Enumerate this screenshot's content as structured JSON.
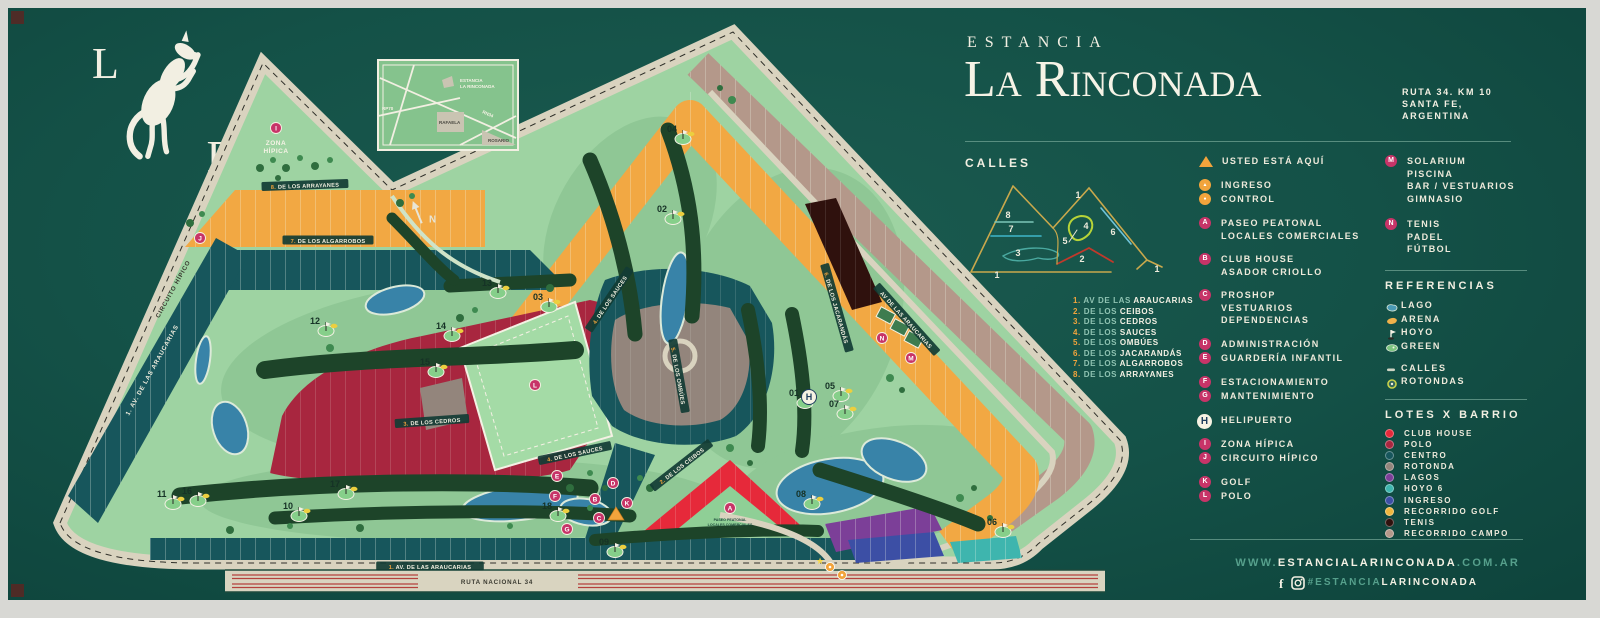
{
  "header": {
    "pretitle": "ESTANCIA",
    "title": "La Rinconada",
    "address": [
      "RUTA 34. KM 10",
      "SANTA FE,",
      "ARGENTINA"
    ]
  },
  "logo": {
    "letter_left": "L",
    "letter_right": "R",
    "icon": "rearing-horse"
  },
  "calles": {
    "heading": "CALLES",
    "streets": [
      {
        "num": "1.",
        "prefix": "AV DE LAS",
        "name": "ARAUCARIAS"
      },
      {
        "num": "2.",
        "prefix": "DE LOS",
        "name": "CEIBOS"
      },
      {
        "num": "3.",
        "prefix": "DE LOS",
        "name": "CEDROS"
      },
      {
        "num": "4.",
        "prefix": "DE LOS",
        "name": "SAUCES"
      },
      {
        "num": "5.",
        "prefix": "DE LOS",
        "name": "OMBÚES"
      },
      {
        "num": "6.",
        "prefix": "DE LOS",
        "name": "JACARANDÁS"
      },
      {
        "num": "7.",
        "prefix": "DE LOS",
        "name": "ALGARROBOS"
      },
      {
        "num": "8.",
        "prefix": "DE LOS",
        "name": "ARRAYANES"
      }
    ],
    "diagram_numbers": [
      {
        "n": "8",
        "x": 47,
        "y": 46
      },
      {
        "n": "7",
        "x": 50,
        "y": 60
      },
      {
        "n": "3",
        "x": 57,
        "y": 84
      },
      {
        "n": "1",
        "x": 36,
        "y": 106
      },
      {
        "n": "1",
        "x": 117,
        "y": 26
      },
      {
        "n": "4",
        "x": 125,
        "y": 57
      },
      {
        "n": "5",
        "x": 104,
        "y": 72
      },
      {
        "n": "2",
        "x": 121,
        "y": 90
      },
      {
        "n": "6",
        "x": 152,
        "y": 63
      },
      {
        "n": "1",
        "x": 196,
        "y": 100
      }
    ]
  },
  "legend": {
    "groups": [
      {
        "items": [
          {
            "marker": "triangle",
            "label_lines": [
              "USTED ESTÁ AQUÍ"
            ]
          }
        ]
      },
      {
        "items": [
          {
            "marker": "ingreso",
            "label_lines": [
              "INGRESO"
            ]
          },
          {
            "marker": "control",
            "label_lines": [
              "CONTROL"
            ]
          }
        ]
      },
      {
        "items": [
          {
            "marker": "A",
            "label_lines": [
              "PASEO PEATONAL",
              "LOCALES COMERCIALES"
            ]
          }
        ]
      },
      {
        "items": [
          {
            "marker": "B",
            "label_lines": [
              "CLUB HOUSE",
              "ASADOR CRIOLLO"
            ]
          }
        ]
      },
      {
        "items": [
          {
            "marker": "C",
            "label_lines": [
              "PROSHOP",
              "VESTUARIOS",
              "DEPENDENCIAS"
            ]
          }
        ]
      },
      {
        "items": [
          {
            "marker": "D",
            "label_lines": [
              "ADMINISTRACIÓN"
            ]
          },
          {
            "marker": "E",
            "label_lines": [
              "GUARDERÍA INFANTIL"
            ]
          }
        ]
      },
      {
        "items": [
          {
            "marker": "F",
            "label_lines": [
              "ESTACIONAMIENTO"
            ]
          },
          {
            "marker": "G",
            "label_lines": [
              "MANTENIMIENTO"
            ]
          }
        ]
      },
      {
        "items": [
          {
            "marker": "H",
            "style": "white",
            "label_lines": [
              "HELIPUERTO"
            ]
          }
        ]
      },
      {
        "items": [
          {
            "marker": "I",
            "label_lines": [
              "ZONA HÍPICA"
            ]
          },
          {
            "marker": "J",
            "label_lines": [
              "CIRCUITO HÍPICO"
            ]
          }
        ]
      },
      {
        "items": [
          {
            "marker": "K",
            "label_lines": [
              "GOLF"
            ]
          },
          {
            "marker": "L",
            "label_lines": [
              "POLO"
            ]
          }
        ]
      }
    ],
    "facilities": [
      {
        "marker": "M",
        "label_lines": [
          "SOLARIUM",
          "PISCINA",
          "BAR / VESTUARIOS",
          "GIMNASIO"
        ]
      },
      {
        "marker": "N",
        "label_lines": [
          "TENIS",
          "PADEL",
          "FÚTBOL"
        ]
      }
    ]
  },
  "referencias": {
    "heading": "REFERENCIAS",
    "items": [
      {
        "icon": "lago-icon",
        "label": "LAGO"
      },
      {
        "icon": "arena-icon",
        "label": "ARENA"
      },
      {
        "icon": "hoyo-icon",
        "label": "HOYO"
      },
      {
        "icon": "green-icon",
        "label": "GREEN"
      },
      {
        "icon": "calles-icon",
        "label": "CALLES",
        "gap_before": true
      },
      {
        "icon": "rotondas-icon",
        "label": "ROTONDAS"
      }
    ]
  },
  "lotes_x_barrio": {
    "heading": "LOTES X BARRIO",
    "items": [
      {
        "label": "CLUB HOUSE",
        "color": "#e6293a"
      },
      {
        "label": "POLO",
        "color": "#a8263f"
      },
      {
        "label": "CENTRO",
        "color": "#17565c"
      },
      {
        "label": "ROTONDA",
        "color": "#93857c"
      },
      {
        "label": "LAGOS",
        "color": "#7c3f98"
      },
      {
        "label": "HOYO 6",
        "color": "#3eb5ae"
      },
      {
        "label": "INGRESO",
        "color": "#3c4fa5"
      },
      {
        "label": "RECORRIDO GOLF",
        "color": "#f0b63e"
      },
      {
        "label": "TENIS",
        "color": "#2f110d"
      },
      {
        "label": "RECORRIDO CAMPO",
        "color": "#b4988a"
      }
    ]
  },
  "footer": {
    "url_pre": "WWW.",
    "url_main": "ESTANCIALARINCONADA",
    "url_suf": ".COM.AR",
    "tag_pre": "#ESTANCIA",
    "tag_main": "LARINCONADA",
    "icons": [
      "facebook-icon",
      "instagram-icon"
    ]
  },
  "map": {
    "zona_hipica": [
      "ZONA",
      "HÍPICA"
    ],
    "paseo_peatonal": [
      "PASEO PEATONAL",
      "LOCALES COMERCIALES"
    ],
    "north_label": "N",
    "inset": {
      "site": [
        "ESTANCIA",
        "LA RINCONADA"
      ],
      "city": "RAFAELA",
      "road_main": "RN34",
      "road_left": "RP70",
      "city2": "ROSARIO"
    },
    "street_labels": [
      {
        "text": "8. DE LOS ARRAYANES",
        "x": 275,
        "y": 168,
        "rot": -2,
        "style": "pill"
      },
      {
        "text": "7. DE LOS ALGARROBOS",
        "x": 298,
        "y": 223,
        "rot": 0,
        "style": "pill"
      },
      {
        "text": "3. DE LOS CEDROS",
        "x": 402,
        "y": 404,
        "rot": -4,
        "style": "pill"
      },
      {
        "text": "4. DE LOS SAUCES",
        "x": 580,
        "y": 282,
        "rot": -56,
        "style": "pill"
      },
      {
        "text": "4. DE LOS SAUCES",
        "x": 545,
        "y": 436,
        "rot": -12,
        "style": "pill"
      },
      {
        "text": "5. DE LOS OMBÚES",
        "x": 648,
        "y": 358,
        "rot": 80,
        "style": "pill"
      },
      {
        "text": "2. DE LOS CEIBOS",
        "x": 652,
        "y": 448,
        "rot": -38,
        "style": "pill"
      },
      {
        "text": "6. DE LOS JACARANDÁS",
        "x": 806,
        "y": 290,
        "rot": 74,
        "style": "pill"
      },
      {
        "text": "AV DE LAS ARAUCARIAS",
        "x": 876,
        "y": 302,
        "rot": 48,
        "style": "pill"
      },
      {
        "text": "1. AV. DE LAS ARAUCARIAS",
        "x": 400,
        "y": 549,
        "rot": 0,
        "style": "pill"
      },
      {
        "text": "1. AV. DE LAS ARAUCARIAS",
        "x": 122,
        "y": 352,
        "rot": -61,
        "style": "band"
      },
      {
        "text": "CIRCUITO HÍPICO",
        "x": 143,
        "y": 271,
        "rot": -61,
        "style": "road"
      },
      {
        "text": "RUTA NACIONAL 34",
        "x": 467,
        "y": 564,
        "rot": 0,
        "style": "road"
      }
    ],
    "holes": [
      {
        "n": "01",
        "x": 759,
        "y": 378
      },
      {
        "n": "02",
        "x": 627,
        "y": 194
      },
      {
        "n": "03",
        "x": 503,
        "y": 282
      },
      {
        "n": "04",
        "x": 637,
        "y": 114
      },
      {
        "n": "05",
        "x": 795,
        "y": 371
      },
      {
        "n": "06",
        "x": 957,
        "y": 507
      },
      {
        "n": "07",
        "x": 799,
        "y": 389
      },
      {
        "n": "08",
        "x": 766,
        "y": 479
      },
      {
        "n": "09",
        "x": 569,
        "y": 527
      },
      {
        "n": "10",
        "x": 253,
        "y": 491
      },
      {
        "n": "11",
        "x": 127,
        "y": 479
      },
      {
        "n": "12",
        "x": 280,
        "y": 306
      },
      {
        "n": "13",
        "x": 452,
        "y": 268
      },
      {
        "n": "14",
        "x": 406,
        "y": 311
      },
      {
        "n": "15",
        "x": 390,
        "y": 347
      },
      {
        "n": "16",
        "x": 152,
        "y": 476
      },
      {
        "n": "17",
        "x": 300,
        "y": 469
      },
      {
        "n": "18",
        "x": 512,
        "y": 491
      }
    ],
    "markers": [
      {
        "t": "pink",
        "l": "I",
        "x": 246,
        "y": 110
      },
      {
        "t": "pink",
        "l": "J",
        "x": 170,
        "y": 220
      },
      {
        "t": "pink",
        "l": "L",
        "x": 505,
        "y": 367
      },
      {
        "t": "pink",
        "l": "A",
        "x": 700,
        "y": 490
      },
      {
        "t": "pink",
        "l": "B",
        "x": 565,
        "y": 481
      },
      {
        "t": "pink",
        "l": "C",
        "x": 569,
        "y": 500
      },
      {
        "t": "pink",
        "l": "D",
        "x": 583,
        "y": 465
      },
      {
        "t": "pink",
        "l": "E",
        "x": 527,
        "y": 458
      },
      {
        "t": "pink",
        "l": "F",
        "x": 525,
        "y": 478
      },
      {
        "t": "pink",
        "l": "G",
        "x": 537,
        "y": 511
      },
      {
        "t": "pink",
        "l": "K",
        "x": 597,
        "y": 485
      },
      {
        "t": "white",
        "l": "H",
        "x": 779,
        "y": 379
      },
      {
        "t": "pink",
        "l": "M",
        "x": 881,
        "y": 340
      },
      {
        "t": "pink",
        "l": "N",
        "x": 852,
        "y": 320
      },
      {
        "t": "tri",
        "x": 586,
        "y": 497
      },
      {
        "t": "gate",
        "x": 800,
        "y": 549
      },
      {
        "t": "gate",
        "x": 812,
        "y": 557
      },
      {
        "t": "star",
        "x": 790,
        "y": 546
      }
    ],
    "visible_lot_number_ranges": [
      {
        "barrio": "CLUB HOUSE",
        "lots": "1-16"
      },
      {
        "barrio": "POLO",
        "lots": "18-39 y 338-372"
      },
      {
        "barrio": "CENTRO",
        "lots": "40-69, 253-294, 295-322, 321-337"
      },
      {
        "barrio": "ROTONDA",
        "lots": "71-90, 375-395"
      },
      {
        "barrio": "RECORRIDO GOLF",
        "lots": "95-163, 396-420"
      },
      {
        "barrio": "HOYO 6",
        "lots": "164-168"
      },
      {
        "barrio": "LAGOS",
        "lots": "169-180"
      },
      {
        "barrio": "INGRESO",
        "lots": "181-187"
      },
      {
        "barrio": "TENIS",
        "lots": "188-196"
      },
      {
        "barrio": "RECORRIDO CAMPO",
        "lots": "198-252"
      }
    ]
  }
}
